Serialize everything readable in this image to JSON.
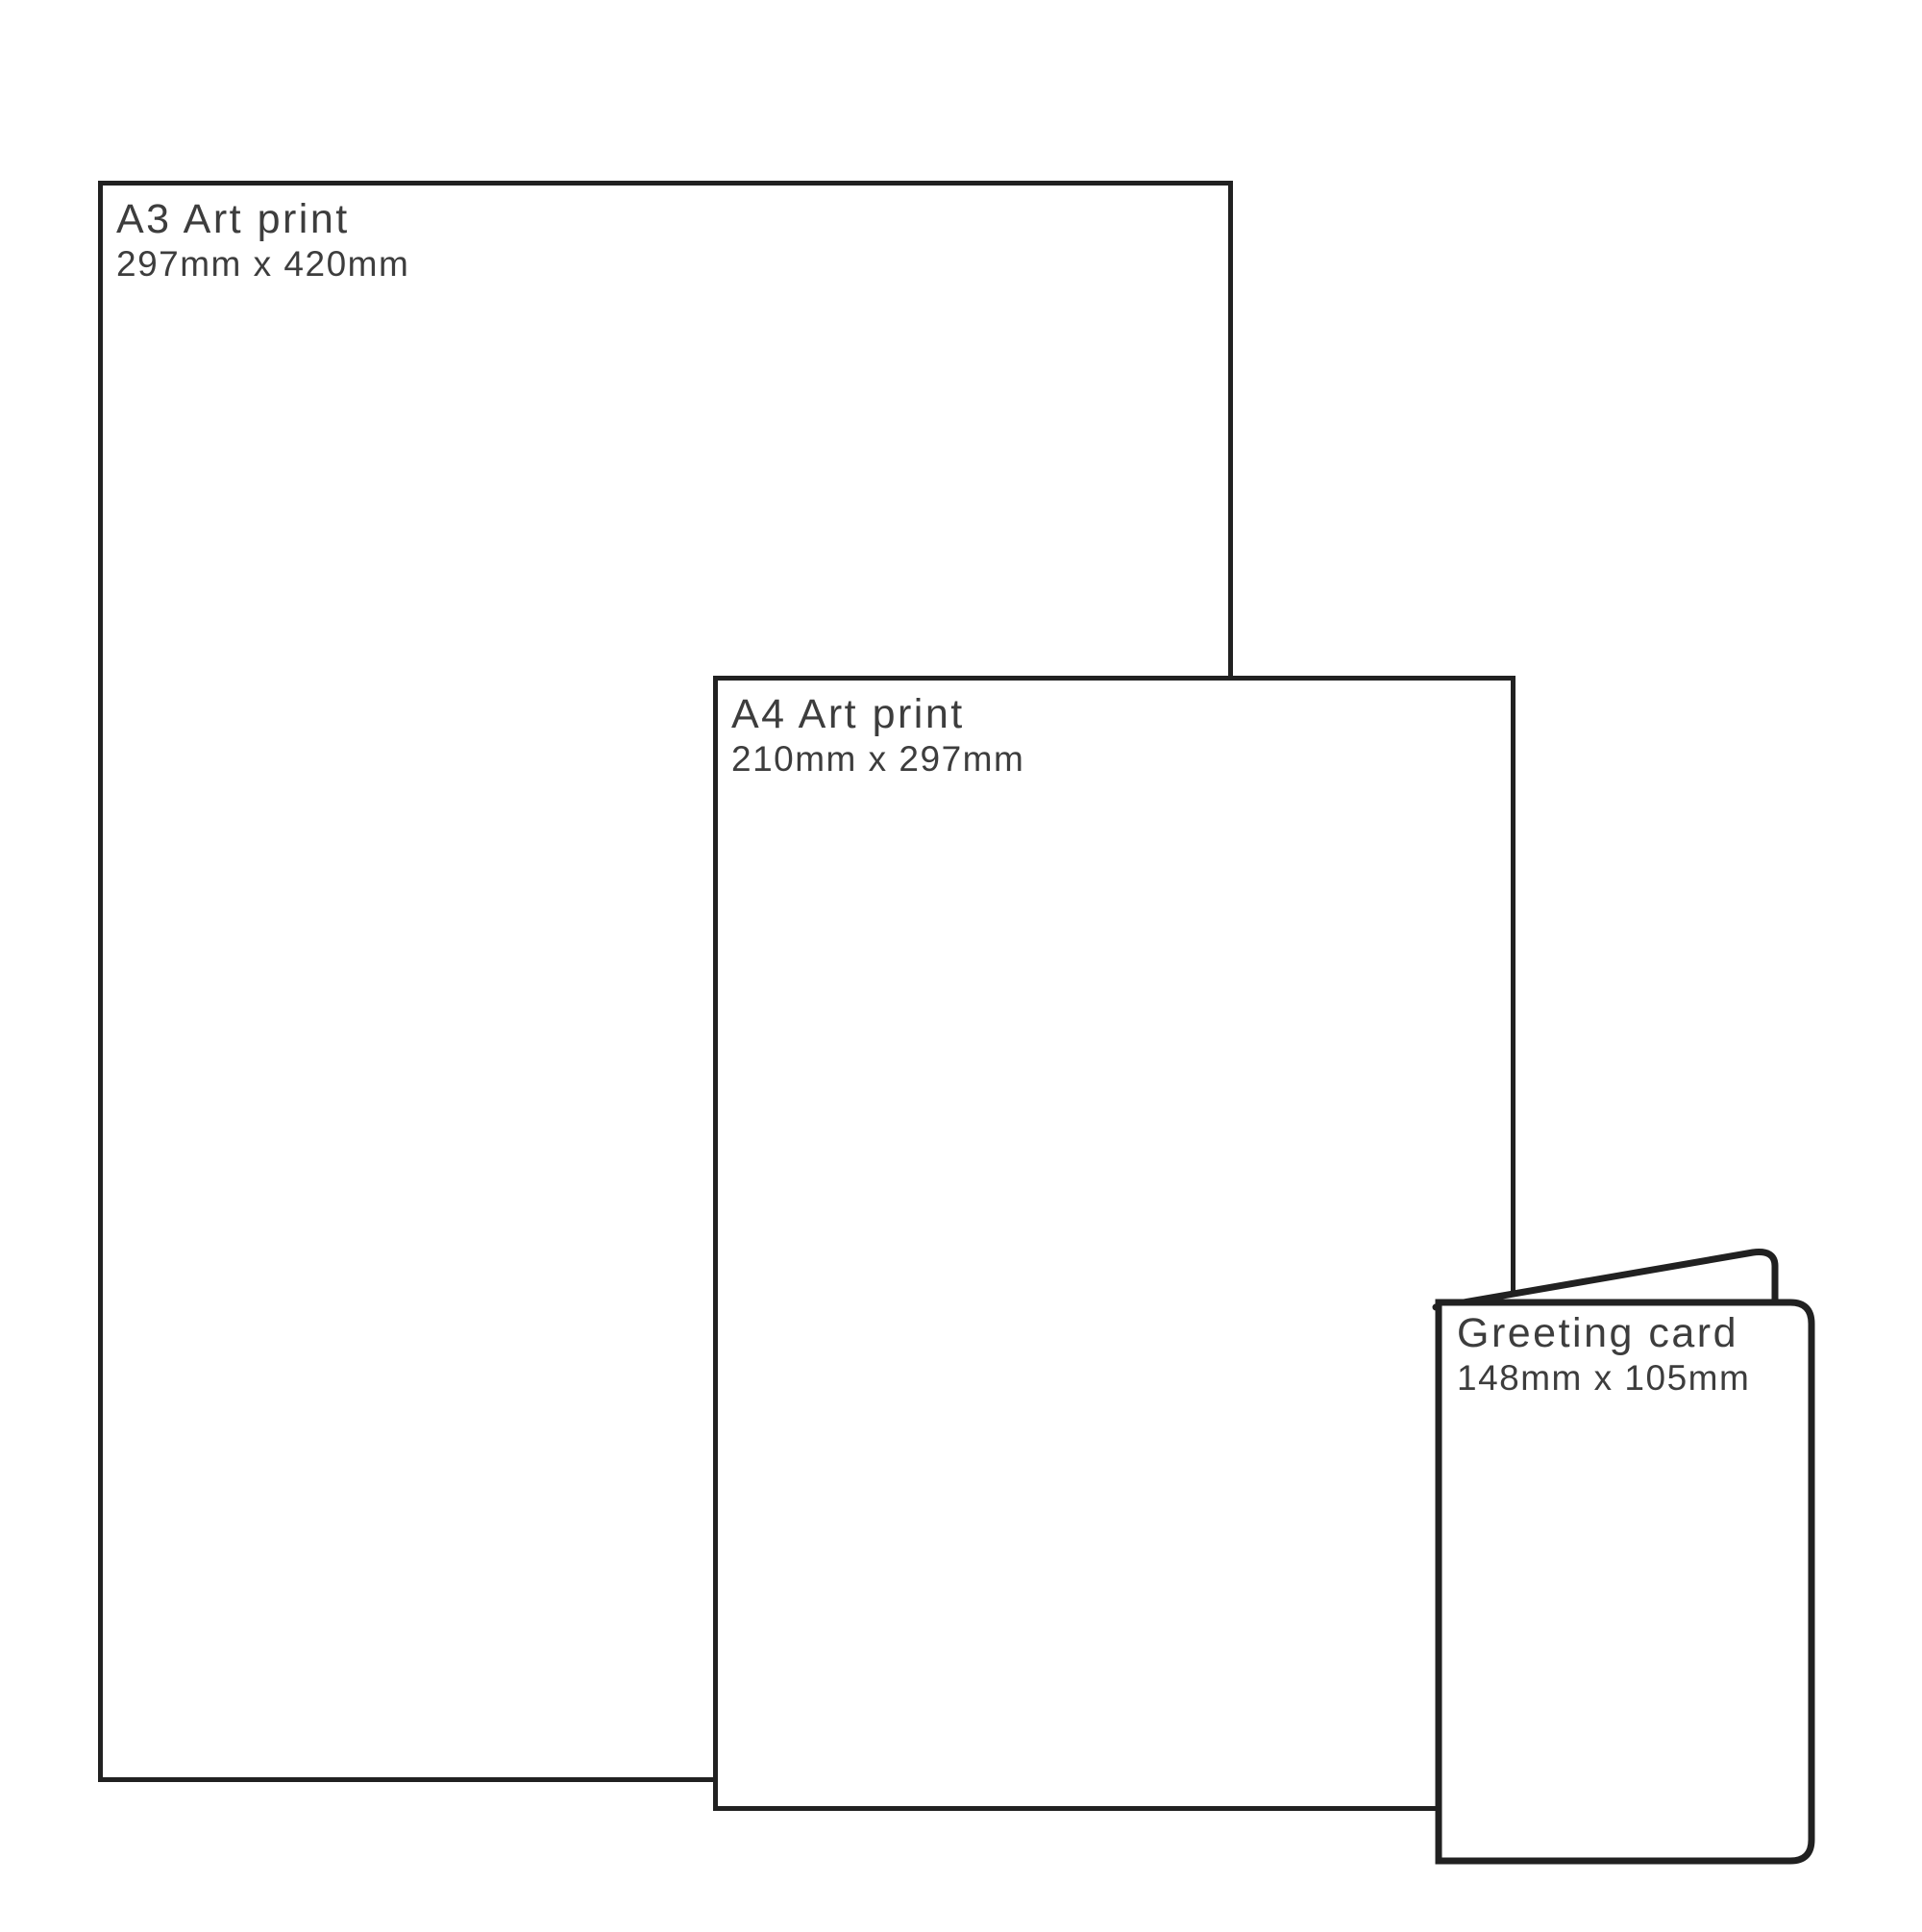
{
  "colors": {
    "background": "#ffffff",
    "outline": "#212121",
    "text": "#3d3d3d"
  },
  "items": [
    {
      "id": "a3-print",
      "label": "A3 Art print",
      "dimensions": "297mm x 420mm"
    },
    {
      "id": "a4-print",
      "label": "A4 Art print",
      "dimensions": "210mm x 297mm"
    },
    {
      "id": "greeting-card",
      "label": "Greeting card",
      "dimensions": "148mm x 105mm"
    }
  ]
}
